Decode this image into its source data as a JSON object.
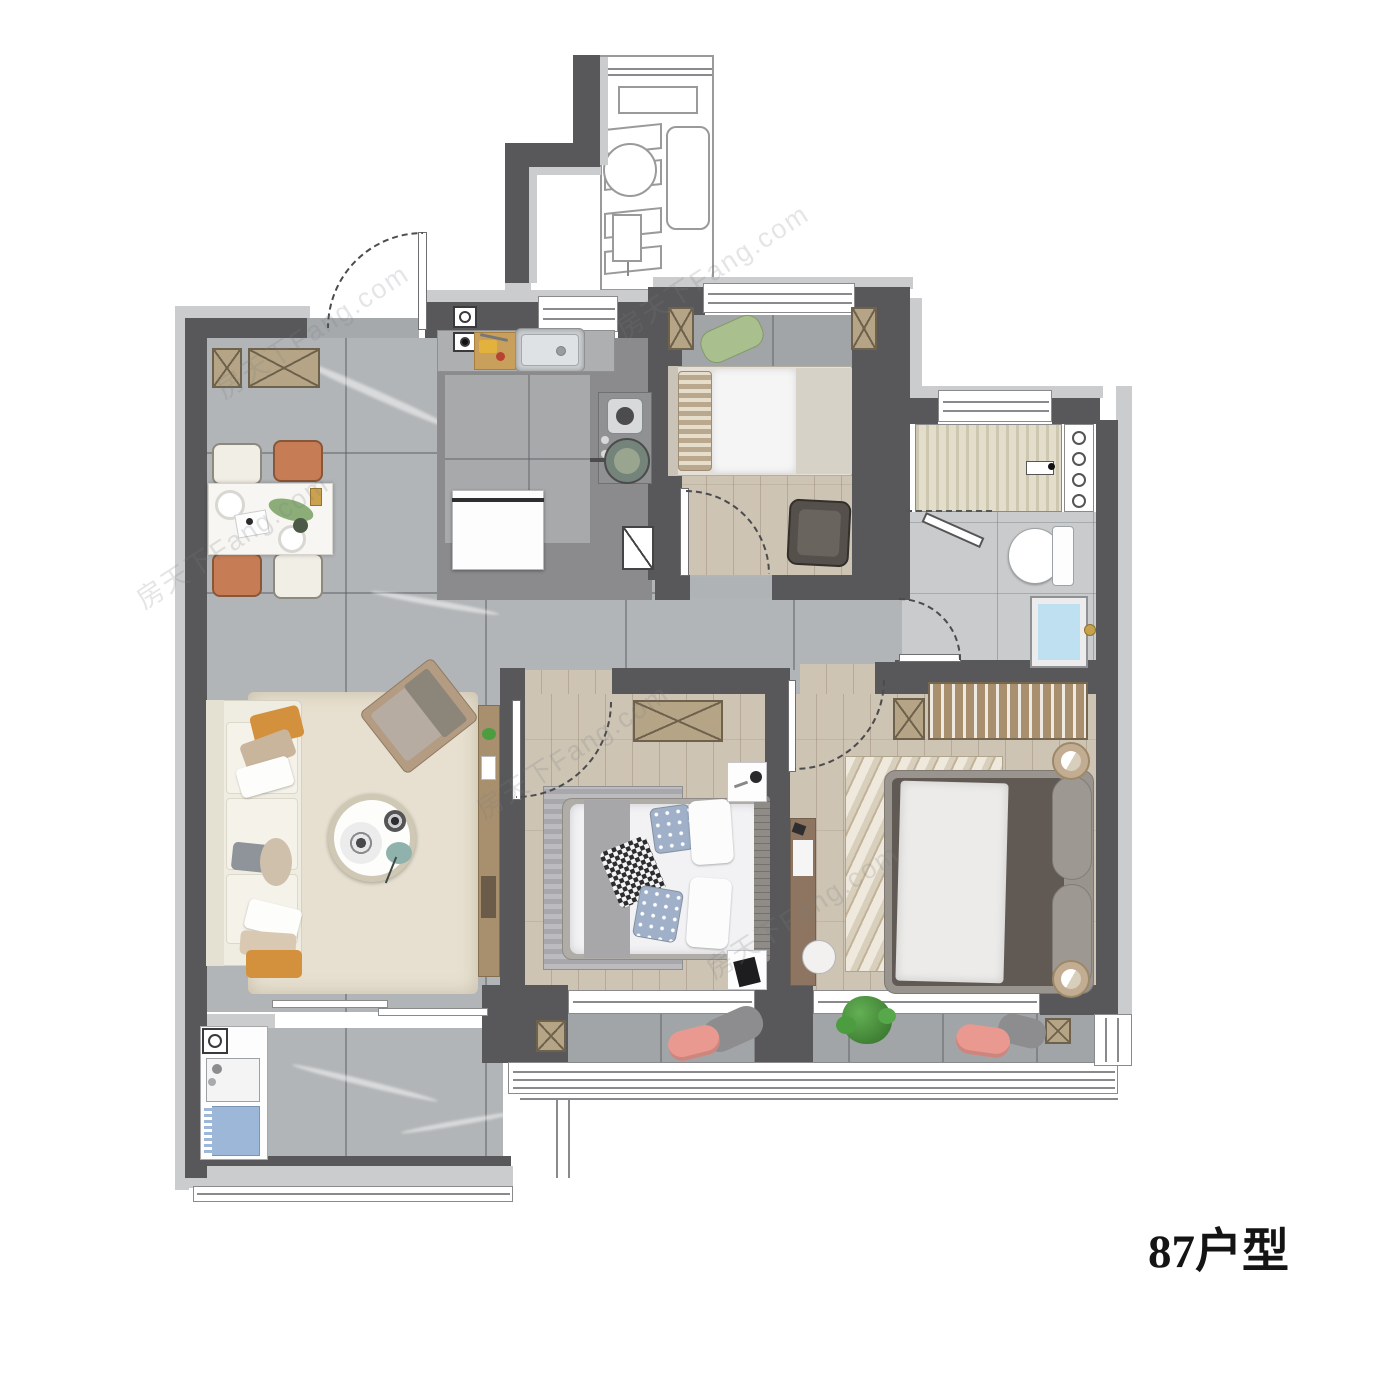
{
  "title": {
    "label": "87户型"
  },
  "watermark": {
    "text": "房天下Fang.com"
  },
  "colors": {
    "wall": "#58585a",
    "lin": "#cbccce",
    "floor": "#b2b5b7",
    "kit": "#8b8b8d",
    "wood": "#cec4b4",
    "balc": "#a2a5a7",
    "bath": "#c9cbcc",
    "rug": "#e7e0d0",
    "tan": "#b5a586",
    "tanD": "#6e624d",
    "wood2": "#a8906f",
    "orange": "#d3913d",
    "terra": "#c67d55",
    "cream": "#f1eee5",
    "bedD": "#615a54",
    "steel": "#c9ccce",
    "blue": "#bfe0f0",
    "green": "#4c9c40",
    "pink": "#e9998f",
    "arcc": "#4c4c4e"
  }
}
